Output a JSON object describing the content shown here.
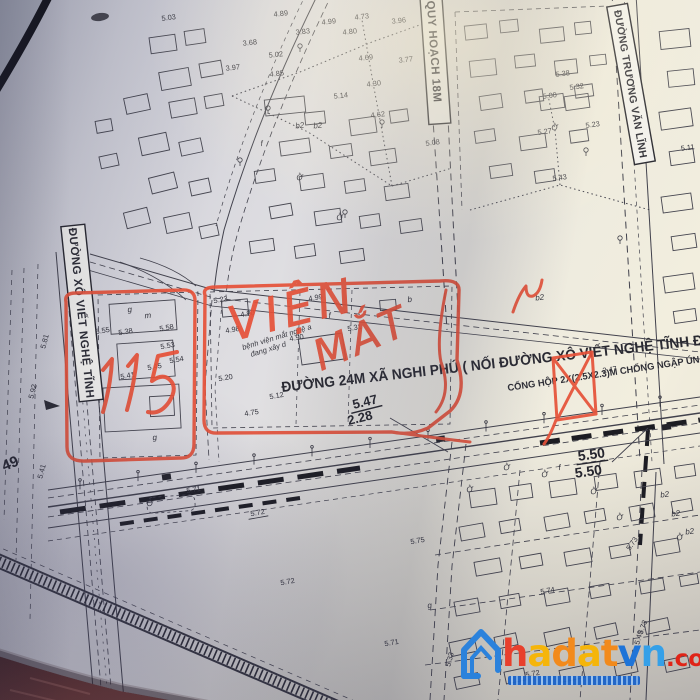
{
  "map": {
    "road_label_boxes": [
      {
        "id": "xo-viet-nghe-tinh",
        "text": "ĐƯỜNG XÔ VIẾT NGHỆ TĨNH"
      },
      {
        "id": "quy-hoach-18m",
        "text": "ĐƯỜNG QUY HOẠCH 18M"
      },
      {
        "id": "truong-van-linh",
        "text": "ĐƯỜNG TRƯƠNG VĂN LĨNH"
      }
    ],
    "main_road_label": "ĐƯỜNG 24M XÃ NGHI PHÚ ( NỐI ĐƯỜNG XÔ VIẾT NGHỆ TĨNH Đ",
    "culvert_label": "CỐNG HỘP 2X(2.5X2.3)M CHỐNG NGẬP ÚN",
    "construction_note": [
      "bệnh viện mắt nghệ a",
      "đang xây d"
    ],
    "dimension_labels": [
      {
        "t": "5.47",
        "x": 366,
        "y": 406,
        "r": -14,
        "s": 13,
        "u": 1
      },
      {
        "t": "2.28",
        "x": 361,
        "y": 422,
        "r": -14,
        "s": 13
      },
      {
        "t": "5.50",
        "x": 592,
        "y": 459,
        "r": -8,
        "s": 14,
        "u": 1
      },
      {
        "t": "5.50",
        "x": 589,
        "y": 476,
        "r": -8,
        "s": 14
      },
      {
        "t": "49",
        "x": 12,
        "y": 468,
        "r": -22,
        "s": 15
      }
    ],
    "spot_elevations": [
      {
        "t": "5.03",
        "x": 169,
        "y": 20,
        "r": -8
      },
      {
        "t": "4.89",
        "x": 281,
        "y": 16,
        "r": -6
      },
      {
        "t": "4.99",
        "x": 329,
        "y": 24,
        "r": -6
      },
      {
        "t": "4.73",
        "x": 362,
        "y": 19,
        "r": -6
      },
      {
        "t": "3.83",
        "x": 303,
        "y": 34,
        "r": -6
      },
      {
        "t": "4.80",
        "x": 350,
        "y": 34,
        "r": -6
      },
      {
        "t": "3.96",
        "x": 399,
        "y": 23,
        "r": -6
      },
      {
        "t": "3.68",
        "x": 250,
        "y": 45,
        "r": -6
      },
      {
        "t": "5.02",
        "x": 276,
        "y": 57,
        "r": -6
      },
      {
        "t": "3.77",
        "x": 406,
        "y": 62,
        "r": -6
      },
      {
        "t": "3.97",
        "x": 233,
        "y": 70,
        "r": -6
      },
      {
        "t": "4.85",
        "x": 277,
        "y": 76,
        "r": -6
      },
      {
        "t": "4.69",
        "x": 366,
        "y": 60,
        "r": -6
      },
      {
        "t": "4.30",
        "x": 374,
        "y": 86,
        "r": -6
      },
      {
        "t": "5.14",
        "x": 341,
        "y": 98,
        "r": -6
      },
      {
        "t": "4.62",
        "x": 378,
        "y": 117,
        "r": -6
      },
      {
        "t": "5.38",
        "x": 563,
        "y": 76,
        "r": -8
      },
      {
        "t": "5.32",
        "x": 577,
        "y": 89,
        "r": -8
      },
      {
        "t": "5.00",
        "x": 550,
        "y": 98,
        "r": -8
      },
      {
        "t": "5.27",
        "x": 545,
        "y": 134,
        "r": -8
      },
      {
        "t": "5.23",
        "x": 593,
        "y": 127,
        "r": -8
      },
      {
        "t": "5.11",
        "x": 688,
        "y": 150,
        "r": -8
      },
      {
        "t": "5.43",
        "x": 560,
        "y": 180,
        "r": -8
      },
      {
        "t": "5.08",
        "x": 433,
        "y": 145,
        "r": -8
      },
      {
        "t": "2.47",
        "x": 610,
        "y": 372,
        "r": -8
      },
      {
        "t": "5.81",
        "x": 47,
        "y": 342,
        "r": -75
      },
      {
        "t": "5.92",
        "x": 35,
        "y": 392,
        "r": -75
      },
      {
        "t": "5.41",
        "x": 44,
        "y": 472,
        "r": -75
      },
      {
        "t": "5.55",
        "x": 103,
        "y": 333,
        "r": -10
      },
      {
        "t": "5.38",
        "x": 126,
        "y": 334,
        "r": -10
      },
      {
        "t": "5.58",
        "x": 167,
        "y": 330,
        "r": -10
      },
      {
        "t": "5.53",
        "x": 168,
        "y": 348,
        "r": -10
      },
      {
        "t": "5.54",
        "x": 177,
        "y": 362,
        "r": -10
      },
      {
        "t": "5.45",
        "x": 155,
        "y": 369,
        "r": -10
      },
      {
        "t": "5.41",
        "x": 128,
        "y": 378,
        "r": -10
      },
      {
        "t": "5.23",
        "x": 221,
        "y": 302,
        "r": -10
      },
      {
        "t": "4.90",
        "x": 248,
        "y": 316,
        "r": -10
      },
      {
        "t": "4.98",
        "x": 233,
        "y": 332,
        "r": -10
      },
      {
        "t": "4.99",
        "x": 316,
        "y": 300,
        "r": -10
      },
      {
        "t": "4.90",
        "x": 297,
        "y": 340,
        "r": -10
      },
      {
        "t": "5.31",
        "x": 355,
        "y": 330,
        "r": -10
      },
      {
        "t": "5.20",
        "x": 226,
        "y": 380,
        "r": -10
      },
      {
        "t": "5.12",
        "x": 277,
        "y": 398,
        "r": -10
      },
      {
        "t": "4.75",
        "x": 252,
        "y": 415,
        "r": -10
      },
      {
        "t": "5.71",
        "x": 194,
        "y": 492,
        "r": -10
      },
      {
        "t": "5.72",
        "x": 258,
        "y": 515,
        "r": -10,
        "u": 1
      },
      {
        "t": "5.75",
        "x": 418,
        "y": 543,
        "r": -10
      },
      {
        "t": "5.73",
        "x": 634,
        "y": 545,
        "r": -55
      },
      {
        "t": "5.72",
        "x": 288,
        "y": 584,
        "r": -10
      },
      {
        "t": "5.74",
        "x": 548,
        "y": 593,
        "r": -10
      },
      {
        "t": "5.71",
        "x": 392,
        "y": 645,
        "r": -10
      },
      {
        "t": "5.72",
        "x": 533,
        "y": 676,
        "r": -10
      },
      {
        "t": "5.73",
        "x": 645,
        "y": 628,
        "r": -70
      },
      {
        "t": "5.33",
        "x": 452,
        "y": 660,
        "r": -75
      },
      {
        "t": "5.49",
        "x": 641,
        "y": 638,
        "r": -75
      }
    ],
    "parcel_letters": [
      {
        "t": "Ở",
        "x": 150,
        "y": 506,
        "r": -5
      },
      {
        "t": "Ở",
        "x": 507,
        "y": 470,
        "r": -8
      },
      {
        "t": "Ở",
        "x": 545,
        "y": 477,
        "r": -8
      },
      {
        "t": "Ở",
        "x": 594,
        "y": 494,
        "r": -8
      },
      {
        "t": "Ở",
        "x": 470,
        "y": 492,
        "r": -8
      },
      {
        "t": "Ở",
        "x": 620,
        "y": 520,
        "r": -8
      },
      {
        "t": "Ở",
        "x": 680,
        "y": 540,
        "r": -8
      },
      {
        "t": "Ở",
        "x": 340,
        "y": 220,
        "r": -8
      },
      {
        "t": "Ở",
        "x": 300,
        "y": 180,
        "r": -8
      },
      {
        "t": "Ở",
        "x": 555,
        "y": 130,
        "r": -8
      },
      {
        "t": "b2",
        "x": 665,
        "y": 497,
        "r": -8
      },
      {
        "t": "b2",
        "x": 676,
        "y": 516,
        "r": -8
      },
      {
        "t": "b2",
        "x": 690,
        "y": 534,
        "r": -8
      },
      {
        "t": "b2",
        "x": 540,
        "y": 300,
        "r": -8
      },
      {
        "t": "b2",
        "x": 300,
        "y": 128,
        "r": -6
      },
      {
        "t": "b2",
        "x": 318,
        "y": 128,
        "r": -6
      },
      {
        "t": "f",
        "x": 330,
        "y": 318,
        "r": -6
      },
      {
        "t": "f",
        "x": 262,
        "y": 146,
        "r": -6
      },
      {
        "t": "g",
        "x": 130,
        "y": 312,
        "r": -6
      },
      {
        "t": "g",
        "x": 155,
        "y": 440,
        "r": -6
      },
      {
        "t": "b",
        "x": 410,
        "y": 302,
        "r": -6
      },
      {
        "t": "m",
        "x": 148,
        "y": 318,
        "r": -6
      },
      {
        "t": "f",
        "x": 560,
        "y": 470,
        "r": -8
      },
      {
        "t": "g",
        "x": 430,
        "y": 608,
        "r": -8
      }
    ]
  },
  "annotations": {
    "marker_color": "#e65138",
    "plot_number": "115",
    "handwritten": [
      "VIỆN",
      "MẮT"
    ]
  },
  "watermark": {
    "brand": [
      {
        "ch": "h",
        "color": "#e8402c"
      },
      {
        "ch": "a",
        "color": "#f5b50a"
      },
      {
        "ch": "d",
        "color": "#f28a1c"
      },
      {
        "ch": "a",
        "color": "#f5b50a"
      },
      {
        "ch": "t",
        "color": "#f28a1c"
      },
      {
        "ch": "v",
        "color": "#1e74d8"
      },
      {
        "ch": "n",
        "color": "#35a0e8"
      }
    ],
    "suffix": ".com.vn",
    "suffix_color": "#e02417",
    "icon": "house-icon",
    "icon_color": "#2b82dc"
  }
}
